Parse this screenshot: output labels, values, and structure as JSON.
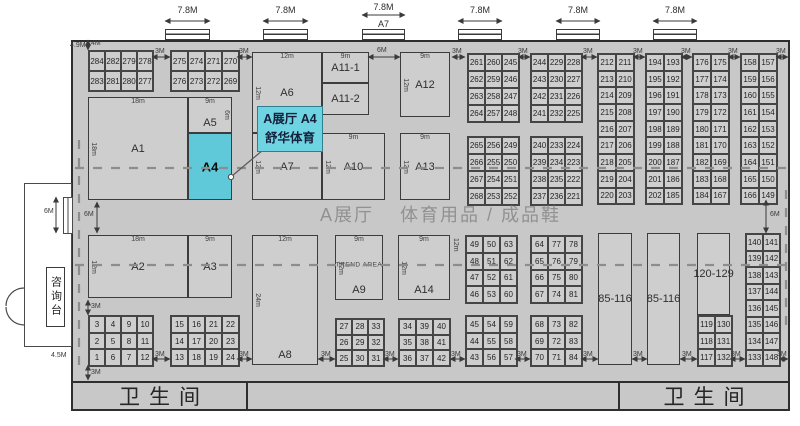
{
  "hall_title": {
    "part1": "A展厅",
    "part2": "体育用品 / 成品鞋"
  },
  "callout": {
    "line1": "A展厅 A4",
    "line2": "舒华体育"
  },
  "info_desk": "咨询台",
  "toilets": {
    "left": "卫生间",
    "right": "卫生间"
  },
  "colors": {
    "hall_fill": "#c8c8c8",
    "booth_fill": "#cecece",
    "highlight": "#5fc9da",
    "callout_fill": "#6fd4e1",
    "callout_border": "#2f7f90",
    "dash": "#8d8d8d",
    "wall": "#2e2e2e"
  },
  "doors_top": [
    {
      "x": 165,
      "w": 45,
      "label": "7.8M"
    },
    {
      "x": 263,
      "w": 45,
      "label": "7.8M"
    },
    {
      "x": 362,
      "w": 43,
      "label": "7.8M",
      "sub": "A7"
    },
    {
      "x": 458,
      "w": 44,
      "label": "7.8M"
    },
    {
      "x": 556,
      "w": 44,
      "label": "7.8M"
    },
    {
      "x": 653,
      "w": 44,
      "label": "7.8M"
    }
  ],
  "large_booths": [
    {
      "id": "A1",
      "x": 88,
      "y": 97,
      "w": 100,
      "h": 103,
      "dim_top": "18m",
      "dim_left": "18m"
    },
    {
      "id": "A5",
      "x": 188,
      "y": 97,
      "w": 44,
      "h": 36,
      "dim_top": "9m",
      "dim_right": "6m",
      "label_pos": "bottom"
    },
    {
      "id": "A4",
      "x": 188,
      "y": 133,
      "w": 44,
      "h": 67,
      "highlight": true
    },
    {
      "id": "A6",
      "x": 252,
      "y": 52,
      "w": 70,
      "h": 81,
      "dim_top": "12m",
      "dim_left": "12m"
    },
    {
      "id": "A11-1",
      "x": 322,
      "y": 52,
      "w": 47,
      "h": 31,
      "dim_top": "9m"
    },
    {
      "id": "A11-2",
      "x": 322,
      "y": 83,
      "w": 47,
      "h": 32
    },
    {
      "id": "A12",
      "x": 400,
      "y": 52,
      "w": 50,
      "h": 65,
      "dim_top": "9m",
      "dim_left": "12m"
    },
    {
      "id": "A7",
      "x": 252,
      "y": 133,
      "w": 70,
      "h": 67,
      "dim_left": "12m"
    },
    {
      "id": "A10",
      "x": 322,
      "y": 133,
      "w": 63,
      "h": 67,
      "dim_top": "9m",
      "dim_left": "12m"
    },
    {
      "id": "A13",
      "x": 400,
      "y": 133,
      "w": 50,
      "h": 67,
      "dim_top": "9m",
      "dim_left": "12m"
    },
    {
      "id": "A2",
      "x": 88,
      "y": 235,
      "w": 100,
      "h": 63,
      "dim_top": "18m",
      "dim_left": "12m"
    },
    {
      "id": "A3",
      "x": 188,
      "y": 235,
      "w": 44,
      "h": 63,
      "dim_top": "9m"
    },
    {
      "id": "A8",
      "x": 252,
      "y": 235,
      "w": 66,
      "h": 130,
      "dim_top": "12m",
      "dim_left": "24m",
      "label_pos": "bottom"
    },
    {
      "id": "A9",
      "x": 335,
      "y": 235,
      "w": 48,
      "h": 65,
      "dim_top": "9m",
      "dim_left": "12m",
      "extra": "TREND AREA",
      "label_pos": "bottom"
    },
    {
      "id": "A14",
      "x": 398,
      "y": 235,
      "w": 52,
      "h": 65,
      "dim_top": "9m",
      "dim_left": "12m",
      "label_pos": "bottom"
    },
    {
      "id": "85-116",
      "x": 598,
      "y": 233,
      "w": 34,
      "h": 132
    },
    {
      "id": "85-116",
      "x": 647,
      "y": 233,
      "w": 33,
      "h": 132
    },
    {
      "id": "120-129",
      "x": 697,
      "y": 233,
      "w": 33,
      "h": 82
    }
  ],
  "grids": [
    {
      "x": 88,
      "y": 50,
      "cw": 16,
      "ch": 20,
      "rows": [
        [
          "284",
          "282",
          "279",
          "278"
        ],
        [
          "283",
          "281",
          "280",
          "277"
        ]
      ]
    },
    {
      "x": 170,
      "y": 50,
      "cw": 17,
      "ch": 20,
      "rows": [
        [
          "275",
          "274",
          "271",
          "270"
        ],
        [
          "276",
          "273",
          "272",
          "269"
        ]
      ]
    },
    {
      "x": 467,
      "y": 53,
      "cw": 17,
      "ch": 17,
      "rows": [
        [
          "261",
          "260",
          "245"
        ],
        [
          "262",
          "259",
          "246"
        ],
        [
          "263",
          "258",
          "247"
        ],
        [
          "264",
          "257",
          "248"
        ]
      ]
    },
    {
      "x": 467,
      "y": 136,
      "cw": 17,
      "ch": 17,
      "rows": [
        [
          "265",
          "256",
          "249"
        ],
        [
          "266",
          "255",
          "250"
        ],
        [
          "267",
          "254",
          "251"
        ],
        [
          "268",
          "253",
          "252"
        ]
      ]
    },
    {
      "x": 530,
      "y": 53,
      "cw": 17,
      "ch": 17,
      "rows": [
        [
          "244",
          "229",
          "228"
        ],
        [
          "243",
          "230",
          "227"
        ],
        [
          "242",
          "231",
          "226"
        ],
        [
          "241",
          "232",
          "225"
        ]
      ]
    },
    {
      "x": 530,
      "y": 136,
      "cw": 17,
      "ch": 17,
      "rows": [
        [
          "240",
          "233",
          "224"
        ],
        [
          "239",
          "234",
          "223"
        ],
        [
          "238",
          "235",
          "222"
        ],
        [
          "237",
          "236",
          "221"
        ]
      ]
    },
    {
      "x": 597,
      "y": 53,
      "cw": 18,
      "ch": 16.7,
      "rows": [
        [
          "212",
          "211"
        ],
        [
          "213",
          "210"
        ],
        [
          "214",
          "209"
        ],
        [
          "215",
          "208"
        ],
        [
          "216",
          "207"
        ],
        [
          "217",
          "206"
        ],
        [
          "218",
          "205"
        ],
        [
          "219",
          "204"
        ],
        [
          "220",
          "203"
        ]
      ]
    },
    {
      "x": 645,
      "y": 53,
      "cw": 18,
      "ch": 16.7,
      "rows": [
        [
          "194",
          "193"
        ],
        [
          "195",
          "192"
        ],
        [
          "196",
          "191"
        ],
        [
          "197",
          "190"
        ],
        [
          "198",
          "189"
        ],
        [
          "199",
          "188"
        ],
        [
          "200",
          "187"
        ],
        [
          "201",
          "186"
        ],
        [
          "202",
          "185"
        ]
      ]
    },
    {
      "x": 692,
      "y": 53,
      "cw": 18,
      "ch": 16.7,
      "rows": [
        [
          "176",
          "175"
        ],
        [
          "177",
          "174"
        ],
        [
          "178",
          "173"
        ],
        [
          "179",
          "172"
        ],
        [
          "180",
          "171"
        ],
        [
          "181",
          "170"
        ],
        [
          "182",
          "169"
        ],
        [
          "183",
          "168"
        ],
        [
          "184",
          "167"
        ]
      ]
    },
    {
      "x": 740,
      "y": 53,
      "cw": 18,
      "ch": 16.7,
      "rows": [
        [
          "158",
          "157"
        ],
        [
          "159",
          "156"
        ],
        [
          "160",
          "155"
        ],
        [
          "161",
          "154"
        ],
        [
          "162",
          "153"
        ],
        [
          "163",
          "152"
        ],
        [
          "164",
          "151"
        ],
        [
          "165",
          "150"
        ],
        [
          "166",
          "149"
        ]
      ]
    },
    {
      "x": 745,
      "y": 233,
      "cw": 17,
      "ch": 16.5,
      "rows": [
        [
          "140",
          "141"
        ],
        [
          "139",
          "142"
        ],
        [
          "138",
          "143"
        ],
        [
          "137",
          "144"
        ],
        [
          "136",
          "145"
        ],
        [
          "135",
          "146"
        ],
        [
          "134",
          "147"
        ],
        [
          "133",
          "148"
        ]
      ]
    },
    {
      "x": 697,
      "y": 315,
      "cw": 17,
      "ch": 16.7,
      "rows": [
        [
          "119",
          "130"
        ],
        [
          "118",
          "131"
        ],
        [
          "117",
          "132"
        ]
      ]
    },
    {
      "x": 465,
      "y": 235,
      "cw": 17,
      "ch": 16.8,
      "rows": [
        [
          "49",
          "50",
          "63"
        ],
        [
          "48",
          "51",
          "62"
        ],
        [
          "47",
          "52",
          "61"
        ],
        [
          "46",
          "53",
          "60"
        ]
      ]
    },
    {
      "x": 530,
      "y": 235,
      "cw": 17,
      "ch": 16.8,
      "rows": [
        [
          "64",
          "77",
          "78"
        ],
        [
          "65",
          "76",
          "79"
        ],
        [
          "66",
          "75",
          "80"
        ],
        [
          "67",
          "74",
          "81"
        ]
      ]
    },
    {
      "x": 465,
      "y": 315,
      "cw": 17,
      "ch": 16.7,
      "rows": [
        [
          "45",
          "54",
          "59"
        ],
        [
          "44",
          "55",
          "58"
        ],
        [
          "43",
          "56",
          "57"
        ]
      ]
    },
    {
      "x": 530,
      "y": 315,
      "cw": 17,
      "ch": 16.7,
      "rows": [
        [
          "68",
          "73",
          "82"
        ],
        [
          "69",
          "72",
          "83"
        ],
        [
          "70",
          "71",
          "84"
        ]
      ]
    },
    {
      "x": 335,
      "y": 318,
      "cw": 16,
      "ch": 15.7,
      "rows": [
        [
          "27",
          "28",
          "33"
        ],
        [
          "26",
          "29",
          "32"
        ],
        [
          "25",
          "30",
          "31"
        ]
      ]
    },
    {
      "x": 398,
      "y": 318,
      "cw": 17,
      "ch": 15.7,
      "rows": [
        [
          "34",
          "39",
          "40"
        ],
        [
          "35",
          "38",
          "41"
        ],
        [
          "36",
          "37",
          "42"
        ]
      ]
    },
    {
      "x": 88,
      "y": 315,
      "cw": 16,
      "ch": 16.7,
      "rows": [
        [
          "3",
          "4",
          "9",
          "10"
        ],
        [
          "2",
          "5",
          "8",
          "11"
        ],
        [
          "1",
          "6",
          "7",
          "12"
        ]
      ]
    },
    {
      "x": 170,
      "y": 315,
      "cw": 17,
      "ch": 16.7,
      "rows": [
        [
          "15",
          "16",
          "21",
          "22"
        ],
        [
          "14",
          "17",
          "20",
          "23"
        ],
        [
          "13",
          "18",
          "19",
          "24"
        ]
      ]
    }
  ],
  "dim_labels": [
    {
      "t": "4M",
      "x": 91,
      "y": 40
    },
    {
      "t": "4.9M",
      "x": 70,
      "y": 42
    },
    {
      "t": "3M",
      "x": 155,
      "y": 48
    },
    {
      "t": "3M",
      "x": 239,
      "y": 48
    },
    {
      "t": "3M",
      "x": 452,
      "y": 48
    },
    {
      "t": "3M",
      "x": 518,
      "y": 48
    },
    {
      "t": "3M",
      "x": 583,
      "y": 48
    },
    {
      "t": "3M",
      "x": 633,
      "y": 48
    },
    {
      "t": "3M",
      "x": 681,
      "y": 48
    },
    {
      "t": "3M",
      "x": 728,
      "y": 48
    },
    {
      "t": "3M",
      "x": 776,
      "y": 48
    },
    {
      "t": "6M",
      "x": 377,
      "y": 47
    },
    {
      "t": "6M",
      "x": 84,
      "y": 211
    },
    {
      "t": "6M",
      "x": 44,
      "y": 208
    },
    {
      "t": "6M",
      "x": 770,
      "y": 211
    },
    {
      "t": "3M",
      "x": 91,
      "y": 303
    },
    {
      "t": "3M",
      "x": 91,
      "y": 369
    },
    {
      "t": "4.5M",
      "x": 51,
      "y": 352
    },
    {
      "t": "3M",
      "x": 155,
      "y": 351
    },
    {
      "t": "3M",
      "x": 239,
      "y": 351
    },
    {
      "t": "3M",
      "x": 321,
      "y": 351
    },
    {
      "t": "3M",
      "x": 385,
      "y": 351
    },
    {
      "t": "3M",
      "x": 451,
      "y": 351
    },
    {
      "t": "3M",
      "x": 517,
      "y": 351
    },
    {
      "t": "3M",
      "x": 583,
      "y": 351
    },
    {
      "t": "3M",
      "x": 633,
      "y": 351
    },
    {
      "t": "3M",
      "x": 682,
      "y": 351
    },
    {
      "t": "3M",
      "x": 731,
      "y": 351
    },
    {
      "t": "3M",
      "x": 777,
      "y": 351
    },
    {
      "t": "12m",
      "x": 452,
      "y": 238,
      "rot": true
    }
  ],
  "arrows": [
    [
      368,
      57,
      400,
      57
    ],
    [
      97,
      202,
      97,
      233
    ],
    [
      56,
      197,
      56,
      233
    ],
    [
      766,
      200,
      766,
      233
    ],
    [
      88,
      40,
      88,
      50
    ],
    [
      88,
      300,
      88,
      315
    ],
    [
      88,
      365,
      88,
      380
    ],
    [
      152,
      57,
      170,
      57
    ],
    [
      237,
      57,
      252,
      57
    ],
    [
      452,
      57,
      465,
      57
    ],
    [
      518,
      57,
      530,
      57
    ],
    [
      581,
      57,
      597,
      57
    ],
    [
      633,
      57,
      645,
      57
    ],
    [
      681,
      57,
      692,
      57
    ],
    [
      728,
      57,
      740,
      57
    ],
    [
      776,
      57,
      788,
      57
    ],
    [
      152,
      359,
      170,
      359
    ],
    [
      237,
      359,
      252,
      359
    ],
    [
      318,
      359,
      335,
      359
    ],
    [
      383,
      359,
      398,
      359
    ],
    [
      450,
      359,
      465,
      359
    ],
    [
      515,
      359,
      530,
      359
    ],
    [
      581,
      359,
      598,
      359
    ],
    [
      632,
      359,
      647,
      359
    ],
    [
      680,
      359,
      697,
      359
    ],
    [
      730,
      359,
      745,
      359
    ],
    [
      779,
      359,
      788,
      359
    ]
  ],
  "dashes": [
    [
      75,
      168,
      787,
      168
    ],
    [
      75,
      265,
      787,
      265
    ],
    [
      79,
      140,
      79,
      373
    ],
    [
      786,
      190,
      786,
      332
    ]
  ],
  "leader": {
    "x1": 263,
    "y1": 150,
    "x2": 232,
    "y2": 176,
    "dot": [
      231,
      177
    ]
  }
}
